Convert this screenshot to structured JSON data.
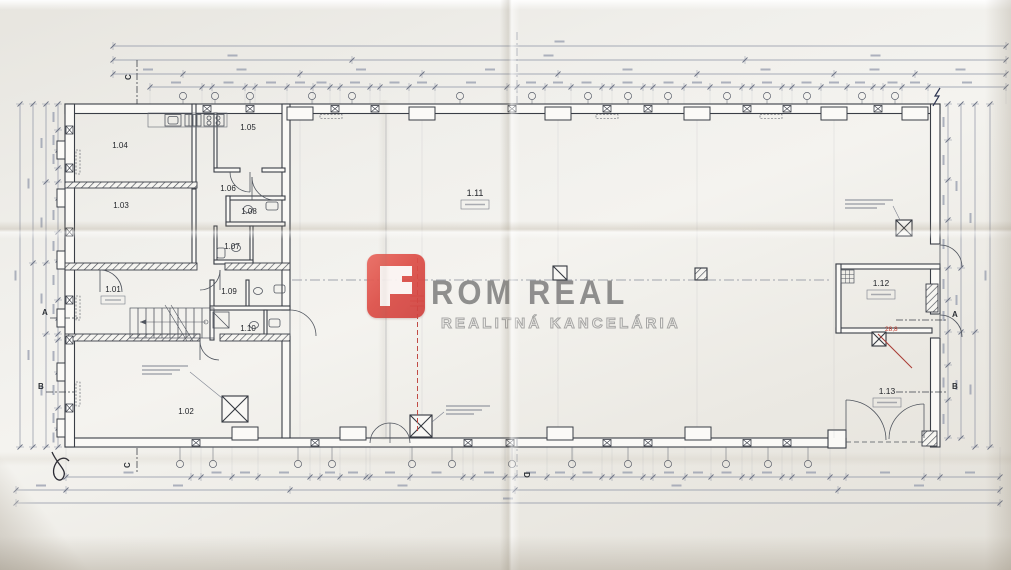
{
  "watermark": {
    "brand": "PROM REAL",
    "brand_rest": "ROM REAL",
    "subtitle": "REALITNÁ KANCELÁRIA",
    "icon_color": "#dd4f48",
    "text_color": "#767676"
  },
  "rooms": [
    "1.01",
    "1.02",
    "1.03",
    "1.04",
    "1.05",
    "1.06",
    "1.07",
    "1.08",
    "1.09",
    "1.10",
    "1.11",
    "1.12",
    "1.13"
  ],
  "markers": {
    "a": "A",
    "b": "B",
    "c": "C",
    "d": "D"
  },
  "notes": {
    "red_note": "28,8"
  },
  "colors": {
    "paper": "#edebe5",
    "line": "#3a3e46",
    "dim": "#8d93a4",
    "red": "#c14b45"
  }
}
